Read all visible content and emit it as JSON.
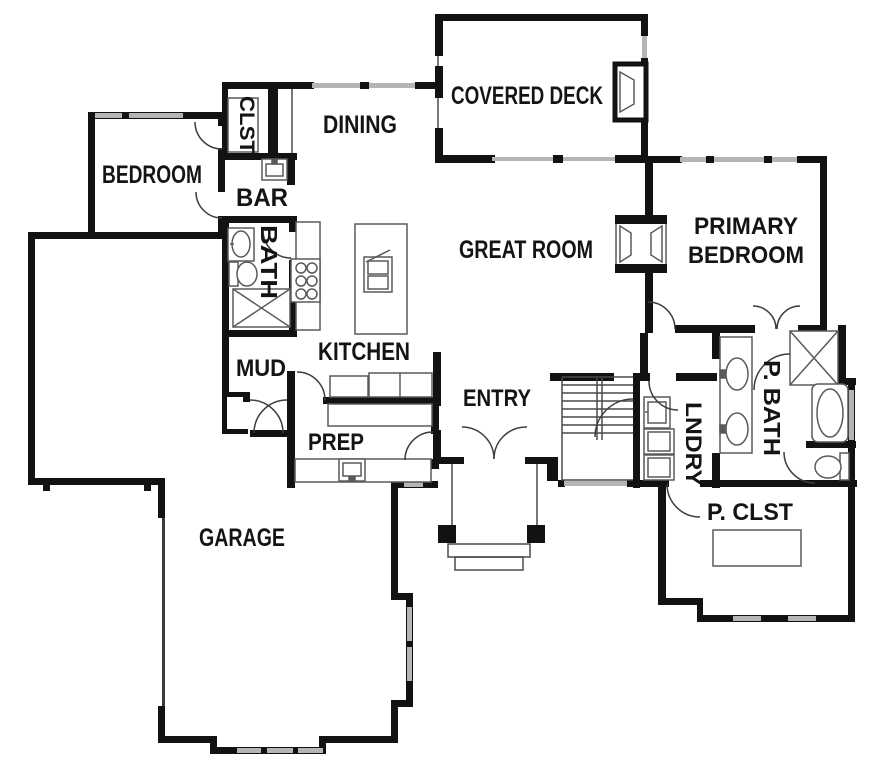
{
  "title": "Main floor plan",
  "colors": {
    "wall": "#121212",
    "window": "#b5b5b5",
    "thin_line": "#4a4a4a",
    "fixture_line": "#5a5a5a",
    "label": "#141414",
    "background": "#ffffff"
  },
  "rooms": {
    "bedroom": {
      "label": "BEDROOM"
    },
    "clst": {
      "label": "CLST"
    },
    "dining": {
      "label": "DINING"
    },
    "covered_deck": {
      "label": "COVERED DECK"
    },
    "bar": {
      "label": "BAR"
    },
    "bath": {
      "label": "BATH"
    },
    "great_room": {
      "label": "GREAT ROOM"
    },
    "primary_bedroom": {
      "label_line1": "PRIMARY",
      "label_line2": "BEDROOM"
    },
    "mud": {
      "label": "MUD"
    },
    "kitchen": {
      "label": "KITCHEN"
    },
    "entry": {
      "label": "ENTRY"
    },
    "lndry": {
      "label": "LNDRY"
    },
    "p_bath": {
      "label": "P. BATH"
    },
    "prep": {
      "label": "PREP"
    },
    "garage": {
      "label": "GARAGE"
    },
    "p_clst": {
      "label": "P. CLST"
    }
  },
  "fixtures": [
    "closet-shelves",
    "bar-sink",
    "bath-vanity-sink",
    "bath-toilet",
    "bath-shower",
    "range-six-burner",
    "kitchen-island",
    "island-sink",
    "base-cabinets",
    "prep-counter",
    "prep-sink",
    "mud-closet",
    "stairs",
    "entry-double-door",
    "porch-columns",
    "porch-steps",
    "laundry-sink",
    "washer",
    "dryer",
    "double-vanity-sinks",
    "walk-in-shower",
    "bathtub",
    "primary-toilet",
    "closet-island",
    "deck-fireplace",
    "double-sided-fireplace"
  ]
}
